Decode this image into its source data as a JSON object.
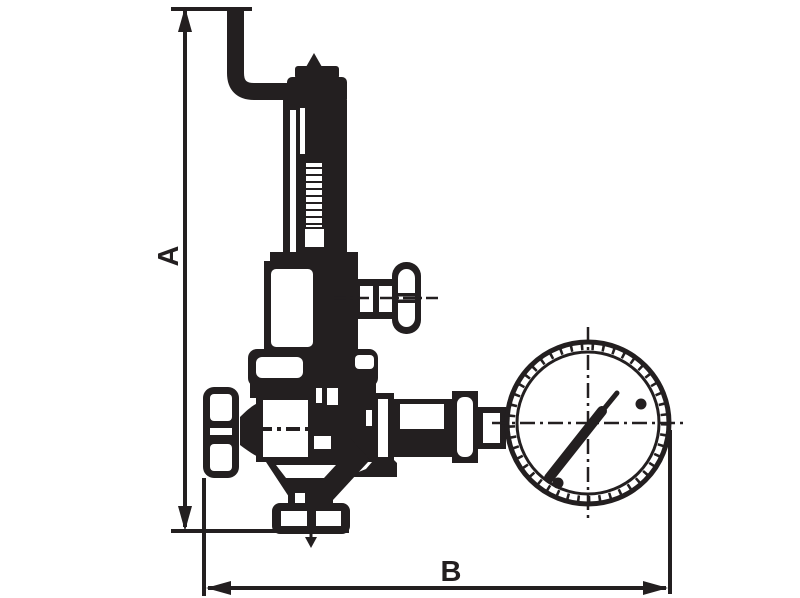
{
  "drawing": {
    "kind": "technical-dimension-drawing",
    "subject": "pressure reducing valve with tee handle, handwheel and pressure gauge",
    "ink_color": "#231f20",
    "background_color": "#ffffff"
  },
  "dimensions": {
    "height_label": "A",
    "width_label": "B"
  }
}
